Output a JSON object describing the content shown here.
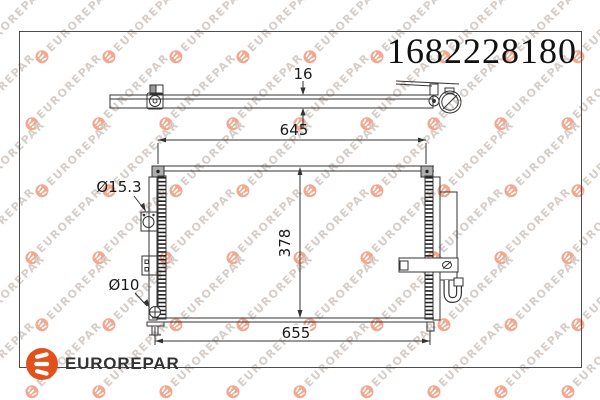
{
  "part_number": "1682228180",
  "brand": {
    "name": "EUROREPAR"
  },
  "watermark": {
    "text": "EUROREPAR"
  },
  "diagram": {
    "dimensions": {
      "thickness": "16",
      "width_top": "645",
      "height": "378",
      "width_bottom": "655",
      "upper_port": "Ø15.3",
      "lower_port": "Ø10"
    }
  },
  "colors": {
    "brand_orange": "#e2511c",
    "line": "#333333",
    "watermark_text": "#d6cec9",
    "watermark_logo": "#f2a78e"
  }
}
